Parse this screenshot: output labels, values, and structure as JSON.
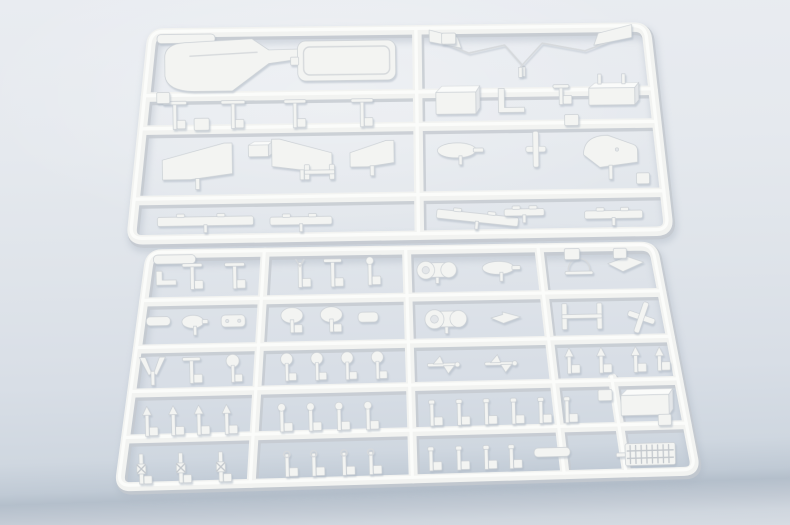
{
  "scene": {
    "width": 790,
    "height": 525,
    "description_colors": {
      "background_top": "#e9ecf1",
      "background_mid": "#dfe4ea",
      "background_low": "#cfd7e0",
      "table_edge_band": "#b4bfcb",
      "plastic_base": "#f3f4f2",
      "plastic_shadow": "#c5cad0",
      "plastic_highlight": "#fdfdfc",
      "cast_shadow": "#aeb8c4"
    }
  },
  "sprues": [
    {
      "name": "sprue-upper",
      "railWidth": 9.5,
      "cornerRadius": 12,
      "quad": {
        "tl": [
          152,
          33
        ],
        "tr": [
          646,
          27
        ],
        "br": [
          669,
          231
        ],
        "bl": [
          131,
          240
        ]
      },
      "hRails": [
        0.31,
        0.47,
        0.81
      ],
      "vRails": [
        0.536
      ],
      "vRailSegs": [],
      "parts": [
        {
          "t": "plate",
          "u": 0.07,
          "v": 0.03,
          "w": 58,
          "h": 9
        },
        {
          "t": "hull",
          "u": 0.2,
          "v": 0.16,
          "w": 168,
          "h": 52
        },
        {
          "t": "plateOutline",
          "u": 0.395,
          "v": 0.145,
          "w": 98,
          "h": 40
        },
        {
          "t": "zigzag",
          "u": 0.655,
          "v": 0.1,
          "w": 94,
          "h": 42,
          "dir": 1
        },
        {
          "t": "zigzag",
          "u": 0.855,
          "v": 0.095,
          "w": 112,
          "h": 46,
          "dir": -1
        },
        {
          "t": "post",
          "top": "bar",
          "u": 0.061,
          "v": 0.4,
          "w": 24,
          "h": 28
        },
        {
          "t": "post",
          "top": "bar",
          "u": 0.175,
          "v": 0.4,
          "w": 24,
          "h": 28
        },
        {
          "t": "post",
          "top": "bar",
          "u": 0.296,
          "v": 0.4,
          "w": 22,
          "h": 28
        },
        {
          "t": "post",
          "top": "bar",
          "u": 0.427,
          "v": 0.4,
          "w": 22,
          "h": 28
        },
        {
          "t": "box3d",
          "u": 0.611,
          "v": 0.345,
          "w": 40,
          "h": 28
        },
        {
          "t": "elbow",
          "u": 0.72,
          "v": 0.35,
          "w": 26,
          "h": 24
        },
        {
          "t": "post",
          "top": "bar",
          "u": 0.818,
          "v": 0.325,
          "w": 16,
          "h": 20
        },
        {
          "t": "box3d",
          "u": 0.918,
          "v": 0.325,
          "w": 46,
          "h": 22,
          "stems": "up"
        },
        {
          "t": "wedge",
          "u": 0.112,
          "v": 0.625,
          "w": 70,
          "h": 36,
          "dir": 1,
          "stem": 10
        },
        {
          "t": "box3d",
          "u": 0.228,
          "v": 0.57,
          "w": 20,
          "h": 15
        },
        {
          "t": "wedge",
          "u": 0.312,
          "v": 0.6,
          "w": 60,
          "h": 32,
          "dir": -1,
          "stem": 9
        },
        {
          "t": "hframe",
          "u": 0.347,
          "v": 0.685,
          "w": 30,
          "h": 15
        },
        {
          "t": "wedge",
          "u": 0.447,
          "v": 0.6,
          "w": 44,
          "h": 26,
          "dir": 1,
          "stem": 9
        },
        {
          "t": "paddle",
          "u": 0.617,
          "v": 0.59,
          "w": 46,
          "h": 15
        },
        {
          "t": "cross",
          "u": 0.762,
          "v": 0.59,
          "w": 20,
          "h": 36
        },
        {
          "t": "whale",
          "u": 0.905,
          "v": 0.605,
          "w": 54,
          "h": 32,
          "stem": 12
        },
        {
          "t": "strip",
          "u": 0.136,
          "v": 0.915,
          "w": 96,
          "h": 9
        },
        {
          "t": "strip",
          "u": 0.315,
          "v": 0.92,
          "w": 62,
          "h": 8
        },
        {
          "t": "strip",
          "u": 0.645,
          "v": 0.92,
          "w": 82,
          "h": 9,
          "rot": 7
        },
        {
          "t": "strip",
          "u": 0.733,
          "v": 0.897,
          "w": 40,
          "h": 7
        },
        {
          "t": "strip",
          "u": 0.9,
          "v": 0.915,
          "w": 58,
          "h": 8
        },
        {
          "t": "pad",
          "u": 0.115,
          "v": 0.445,
          "w": 15,
          "h": 12
        },
        {
          "t": "pad",
          "u": 0.6,
          "v": 0.045,
          "w": 14,
          "h": 11
        },
        {
          "t": "pad",
          "u": 0.835,
          "v": 0.45,
          "w": 14,
          "h": 11
        },
        {
          "t": "pad",
          "u": 0.962,
          "v": 0.74,
          "w": 13,
          "h": 11
        },
        {
          "t": "pad",
          "u": 0.035,
          "v": 0.315,
          "w": 13,
          "h": 11
        }
      ]
    },
    {
      "name": "sprue-lower",
      "railWidth": 9,
      "cornerRadius": 12,
      "quad": {
        "tl": [
          150,
          254
        ],
        "tr": [
          653,
          246
        ],
        "br": [
          696,
          471
        ],
        "bl": [
          119,
          487
        ]
      },
      "hRails": [
        0.206,
        0.408,
        0.597,
        0.794
      ],
      "vRails": [
        0.229,
        0.51,
        0.773
      ],
      "vRailSegs": [
        {
          "u": 0.88,
          "v0": 0.58,
          "v1": 1
        }
      ],
      "parts": [
        {
          "t": "plate",
          "u": 0.05,
          "v": 0.025,
          "w": 42,
          "h": 9
        },
        {
          "t": "elbow",
          "u": 0.038,
          "v": 0.105,
          "w": 20,
          "h": 14
        },
        {
          "t": "post",
          "top": "bar",
          "u": 0.089,
          "v": 0.1,
          "w": 20,
          "h": 26
        },
        {
          "t": "post",
          "top": "bar",
          "u": 0.172,
          "v": 0.1,
          "w": 20,
          "h": 26
        },
        {
          "t": "post",
          "top": "fork",
          "u": 0.3,
          "v": 0.095,
          "w": 18,
          "h": 28
        },
        {
          "t": "post",
          "top": "bar",
          "u": 0.364,
          "v": 0.095,
          "w": 18,
          "h": 28
        },
        {
          "t": "post",
          "top": "ball",
          "u": 0.437,
          "v": 0.09,
          "w": 14,
          "h": 28
        },
        {
          "t": "winch",
          "u": 0.569,
          "v": 0.09,
          "w": 44,
          "h": 26
        },
        {
          "t": "paddle",
          "u": 0.695,
          "v": 0.085,
          "w": 38,
          "h": 13
        },
        {
          "t": "arc",
          "u": 0.848,
          "v": 0.075,
          "w": 28,
          "h": 18
        },
        {
          "t": "dart",
          "u": 0.94,
          "v": 0.075,
          "w": 36,
          "h": 18
        },
        {
          "t": "pad",
          "u": 0.837,
          "v": 0.03,
          "w": 15,
          "h": 11
        },
        {
          "t": "pad",
          "u": 0.932,
          "v": 0.03,
          "w": 13,
          "h": 10
        },
        {
          "t": "plate",
          "u": 0.033,
          "v": 0.29,
          "w": 24,
          "h": 9
        },
        {
          "t": "paddle",
          "u": 0.103,
          "v": 0.295,
          "w": 26,
          "h": 13
        },
        {
          "t": "plate",
          "u": 0.176,
          "v": 0.295,
          "w": 24,
          "h": 12,
          "dots": 2
        },
        {
          "t": "dome",
          "u": 0.288,
          "v": 0.295,
          "w": 22,
          "h": 26
        },
        {
          "t": "dome",
          "u": 0.363,
          "v": 0.295,
          "w": 22,
          "h": 26
        },
        {
          "t": "plate",
          "u": 0.433,
          "v": 0.29,
          "w": 20,
          "h": 10
        },
        {
          "t": "winch",
          "u": 0.582,
          "v": 0.305,
          "w": 46,
          "h": 28
        },
        {
          "t": "dart",
          "u": 0.695,
          "v": 0.305,
          "w": 30,
          "h": 12
        },
        {
          "t": "hframe",
          "u": 0.84,
          "v": 0.305,
          "w": 40,
          "h": 26
        },
        {
          "t": "cross",
          "u": 0.952,
          "v": 0.315,
          "w": 28,
          "h": 32,
          "rot": 20
        },
        {
          "t": "tail",
          "u": 0.034,
          "v": 0.505,
          "w": 26,
          "h": 28
        },
        {
          "t": "post",
          "top": "bar",
          "u": 0.106,
          "v": 0.505,
          "w": 18,
          "h": 26
        },
        {
          "t": "ball",
          "u": 0.182,
          "v": 0.5,
          "w": 13,
          "h": 28
        },
        {
          "t": "ball",
          "u": 0.282,
          "v": 0.5,
          "w": 12,
          "h": 28
        },
        {
          "t": "ball",
          "u": 0.338,
          "v": 0.5,
          "w": 12,
          "h": 28
        },
        {
          "t": "ball",
          "u": 0.394,
          "v": 0.5,
          "w": 12,
          "h": 28
        },
        {
          "t": "ball",
          "u": 0.45,
          "v": 0.5,
          "w": 12,
          "h": 28
        },
        {
          "t": "anchor",
          "u": 0.572,
          "v": 0.505,
          "w": 32,
          "h": 18
        },
        {
          "t": "anchor",
          "u": 0.678,
          "v": 0.505,
          "w": 32,
          "h": 18
        },
        {
          "t": "post",
          "top": "cone",
          "u": 0.805,
          "v": 0.5,
          "w": 14,
          "h": 26
        },
        {
          "t": "post",
          "top": "cone",
          "u": 0.864,
          "v": 0.5,
          "w": 14,
          "h": 26
        },
        {
          "t": "post",
          "top": "cone",
          "u": 0.928,
          "v": 0.5,
          "w": 14,
          "h": 26
        },
        {
          "t": "post",
          "top": "cone",
          "u": 0.972,
          "v": 0.5,
          "w": 12,
          "h": 24
        },
        {
          "t": "post",
          "top": "cone",
          "u": 0.035,
          "v": 0.72,
          "w": 15,
          "h": 30
        },
        {
          "t": "post",
          "top": "cone",
          "u": 0.082,
          "v": 0.72,
          "w": 15,
          "h": 30
        },
        {
          "t": "post",
          "top": "cone",
          "u": 0.128,
          "v": 0.72,
          "w": 15,
          "h": 30
        },
        {
          "t": "post",
          "top": "cone",
          "u": 0.178,
          "v": 0.72,
          "w": 15,
          "h": 30
        },
        {
          "t": "post",
          "top": "ball",
          "u": 0.277,
          "v": 0.72,
          "w": 12,
          "h": 28
        },
        {
          "t": "post",
          "top": "ball",
          "u": 0.329,
          "v": 0.72,
          "w": 12,
          "h": 28
        },
        {
          "t": "post",
          "top": "ball",
          "u": 0.38,
          "v": 0.72,
          "w": 12,
          "h": 28
        },
        {
          "t": "post",
          "top": "ball",
          "u": 0.432,
          "v": 0.72,
          "w": 12,
          "h": 28
        },
        {
          "t": "post",
          "top": "cap",
          "u": 0.547,
          "v": 0.715,
          "w": 10,
          "h": 26
        },
        {
          "t": "post",
          "top": "cap",
          "u": 0.596,
          "v": 0.715,
          "w": 10,
          "h": 26
        },
        {
          "t": "post",
          "top": "cap",
          "u": 0.645,
          "v": 0.715,
          "w": 10,
          "h": 26
        },
        {
          "t": "post",
          "top": "cap",
          "u": 0.694,
          "v": 0.715,
          "w": 10,
          "h": 26
        },
        {
          "t": "post",
          "top": "cap",
          "u": 0.743,
          "v": 0.715,
          "w": 10,
          "h": 26
        },
        {
          "t": "post",
          "top": "cap",
          "u": 0.79,
          "v": 0.715,
          "w": 10,
          "h": 26
        },
        {
          "t": "box3d",
          "u": 0.932,
          "v": 0.69,
          "w": 48,
          "h": 26
        },
        {
          "t": "pad",
          "u": 0.862,
          "v": 0.655,
          "w": 14,
          "h": 11
        },
        {
          "t": "bollard",
          "u": 0.035,
          "v": 0.925,
          "w": 14,
          "h": 30
        },
        {
          "t": "bollard",
          "u": 0.104,
          "v": 0.925,
          "w": 14,
          "h": 30
        },
        {
          "t": "bollard",
          "u": 0.174,
          "v": 0.925,
          "w": 14,
          "h": 30
        },
        {
          "t": "post",
          "top": "ring",
          "u": 0.29,
          "v": 0.92,
          "w": 12,
          "h": 26
        },
        {
          "t": "post",
          "top": "ring",
          "u": 0.337,
          "v": 0.92,
          "w": 12,
          "h": 26
        },
        {
          "t": "post",
          "top": "ring",
          "u": 0.39,
          "v": 0.92,
          "w": 12,
          "h": 26
        },
        {
          "t": "post",
          "top": "ring",
          "u": 0.437,
          "v": 0.92,
          "w": 12,
          "h": 26
        },
        {
          "t": "post",
          "top": "cap",
          "u": 0.542,
          "v": 0.915,
          "w": 10,
          "h": 24
        },
        {
          "t": "post",
          "top": "cap",
          "u": 0.591,
          "v": 0.915,
          "w": 10,
          "h": 24
        },
        {
          "t": "post",
          "top": "cap",
          "u": 0.639,
          "v": 0.915,
          "w": 10,
          "h": 24
        },
        {
          "t": "post",
          "top": "cap",
          "u": 0.683,
          "v": 0.915,
          "w": 10,
          "h": 24
        },
        {
          "t": "plate",
          "u": 0.755,
          "v": 0.9,
          "w": 36,
          "h": 9
        },
        {
          "t": "ladder",
          "u": 0.926,
          "v": 0.92,
          "w": 50,
          "h": 22
        },
        {
          "t": "pad",
          "u": 0.962,
          "v": 0.77,
          "w": 13,
          "h": 11
        }
      ]
    }
  ]
}
